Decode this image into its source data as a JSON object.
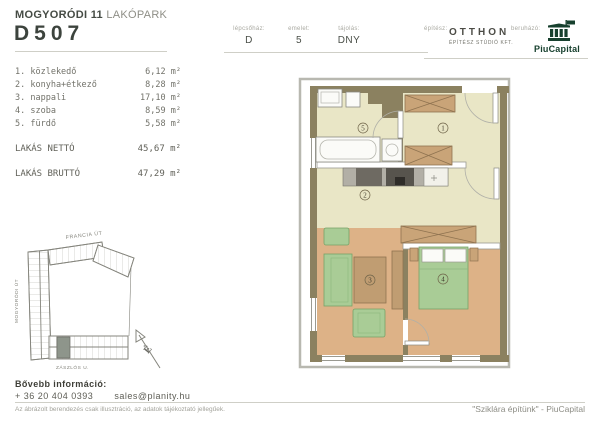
{
  "header": {
    "project_bold": "MOGYORÓDI 11",
    "project_light": "LAKÓPARK",
    "unit_id": "D507",
    "meta": [
      {
        "label": "lépcsőház:",
        "value": "D"
      },
      {
        "label": "emelet:",
        "value": "5"
      },
      {
        "label": "tájolás:",
        "value": "DNY"
      }
    ],
    "architect_label": "építész:",
    "architect_name": "OTTHON",
    "architect_sub": "ÉPÍTÉSZ STÚDIÓ KFT.",
    "developer_label": "beruházó:",
    "developer_name": "PiuCapital"
  },
  "rooms": [
    {
      "name": "1. közlekedő",
      "area": "6,12 m²"
    },
    {
      "name": "2. konyha+étkező",
      "area": "8,28 m²"
    },
    {
      "name": "3. nappali",
      "area": "17,10 m²"
    },
    {
      "name": "4. szoba",
      "area": "8,59 m²"
    },
    {
      "name": "5. fürdő",
      "area": "5,58 m²"
    }
  ],
  "totals": [
    {
      "label": "LAKÁS NETTÓ",
      "value": "45,67 m²"
    },
    {
      "label": "LAKÁS BRUTTÓ",
      "value": "47,29 m²"
    }
  ],
  "floorplan": {
    "labels": [
      "1",
      "2",
      "3",
      "4",
      "5"
    ]
  },
  "site_plan": {
    "streets": {
      "top": "FRANCIA ÚT",
      "left": "MOGYORÓDI ÚT",
      "bottom": "ZÁSZLÓS U."
    },
    "north": "É"
  },
  "footer": {
    "info_label": "Bővebb információ:",
    "phone": "+ 36 20 404 0393",
    "email": "sales@planity.hu",
    "disclaimer": "Az ábrázolt berendezés csak illusztráció, az adatok tájékoztató jellegűek.",
    "quote": "\"Sziklára építünk\" - PiuCapital"
  },
  "icons": {
    "developer_logo": "bank-building-icon",
    "north": "north-arrow-icon"
  },
  "colors": {
    "brand_green": "#17402e",
    "wall_olive": "#8b8160",
    "floor_pale": "#e9e6c6",
    "floor_tan": "#ddb287",
    "furniture_green": "#a9cc96",
    "furniture_wood": "#c9a478",
    "text_dark": "#3c433d",
    "text_gray": "#8d8d85",
    "line_gray": "#cfcfc7"
  }
}
